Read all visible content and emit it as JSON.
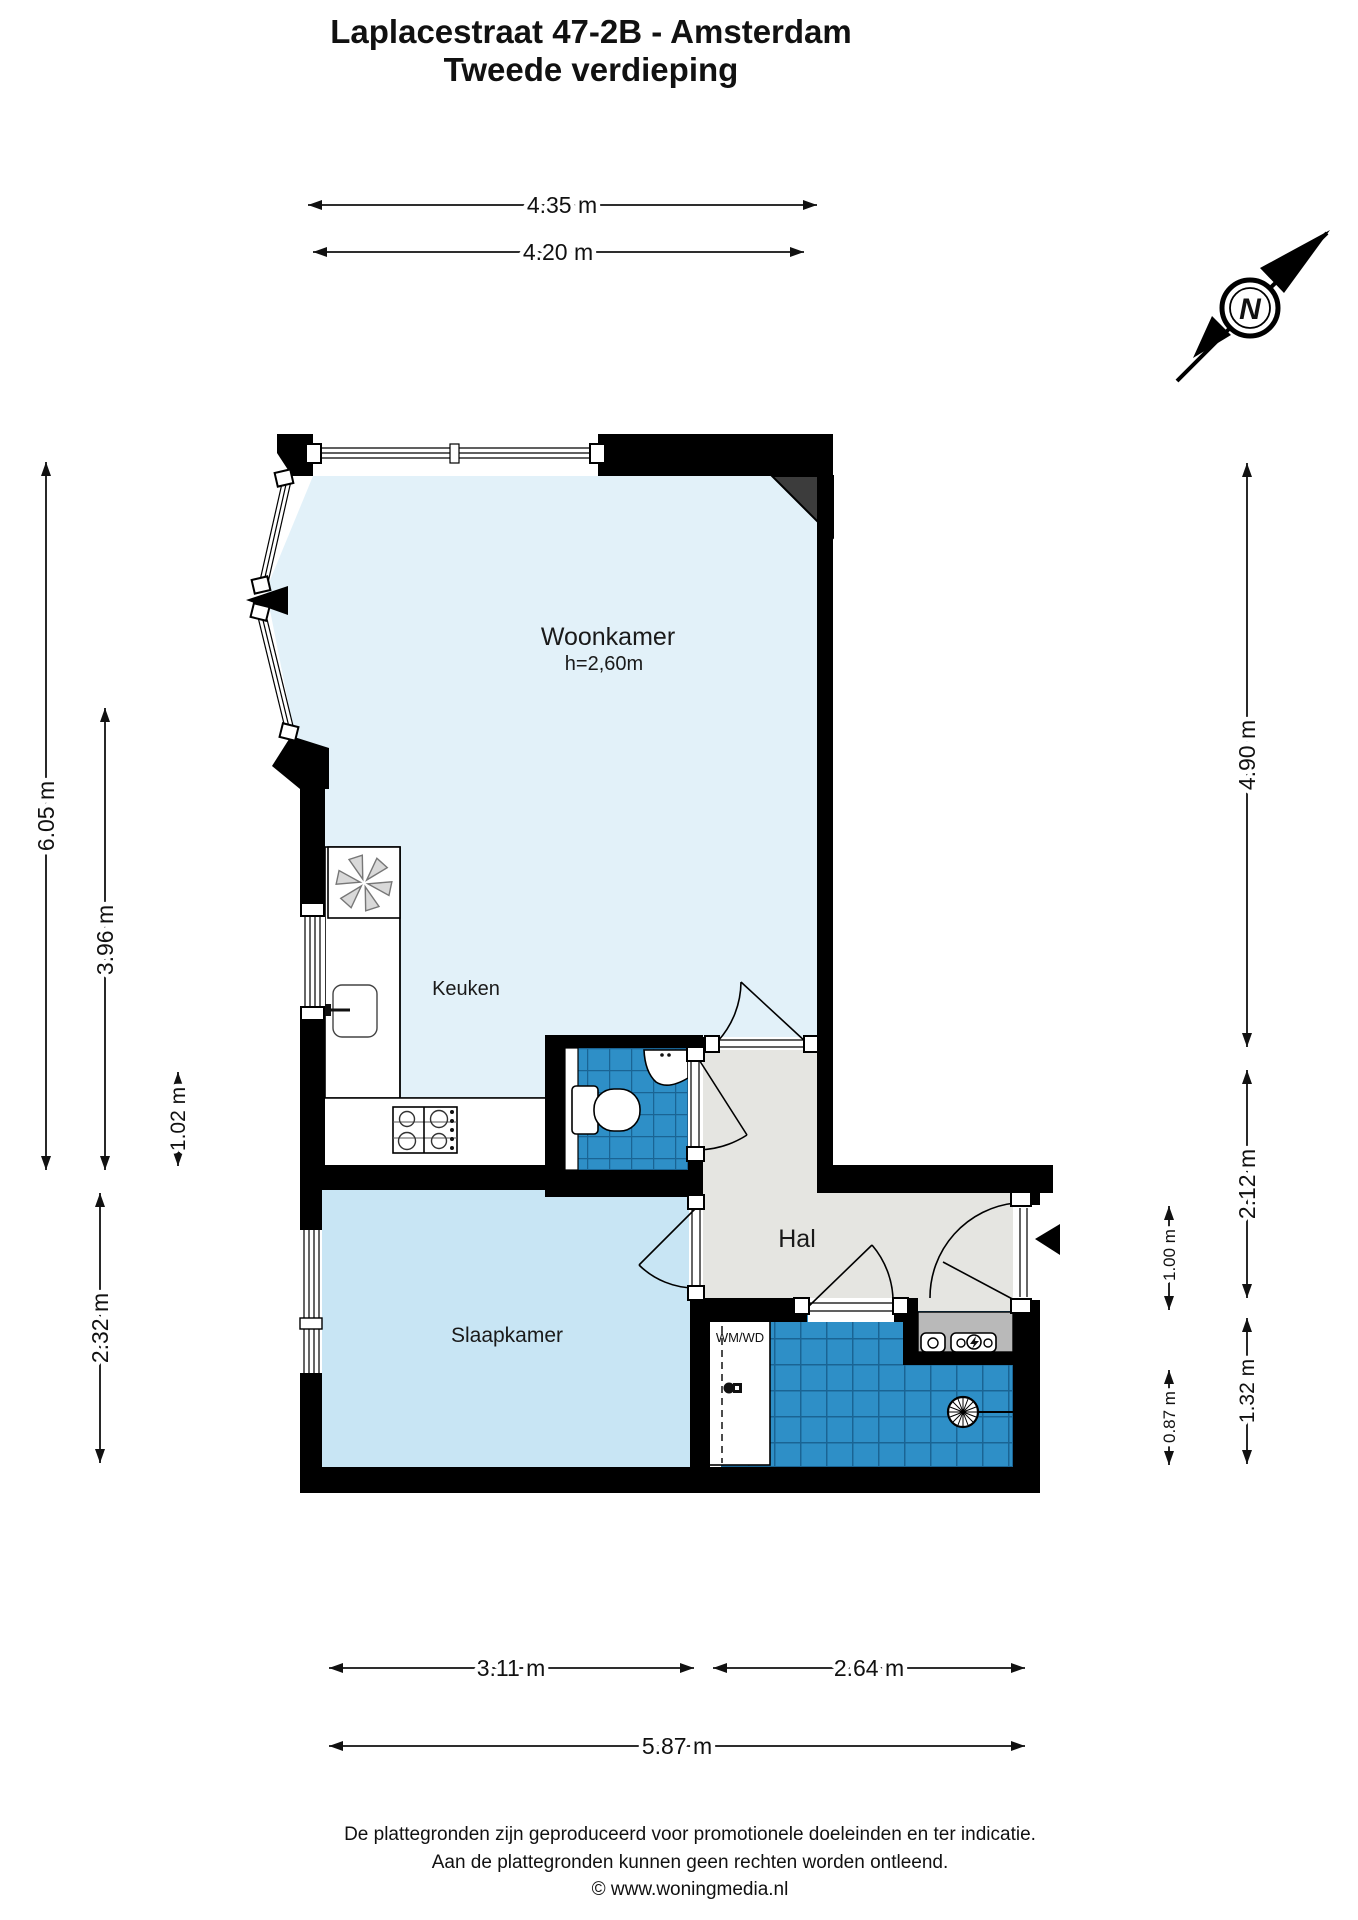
{
  "title": {
    "line1": "Laplacestraat 47-2B - Amsterdam",
    "line2": "Tweede verdieping"
  },
  "compass": {
    "north_label": "N"
  },
  "rooms": {
    "woonkamer": {
      "label": "Woonkamer",
      "ceiling_height": "h=2,60m"
    },
    "keuken": {
      "label": "Keuken"
    },
    "hal": {
      "label": "Hal"
    },
    "slaapkamer": {
      "label": "Slaapkamer"
    },
    "badkamer": {
      "washer_label": "WM/WD"
    }
  },
  "dimensions": {
    "top_outer": "4.35 m",
    "top_inner": "4.20 m",
    "left_outer": "6.05 m",
    "left_kitchen": "3.96 m",
    "left_small": "1.02 m",
    "left_bedroom": "2.32 m",
    "right_livingroom": "4.90 m",
    "right_hal": "2.12 m",
    "right_entrance": "1.00 m",
    "right_bathroom": "1.32 m",
    "right_niche": "0.87 m",
    "bottom_bedroom": "3.11 m",
    "bottom_bathroom": "2.64 m",
    "bottom_total": "5.87 m"
  },
  "footer": {
    "line1": "De plattegronden zijn geproduceerd voor promotionele doeleinden en ter indicatie.",
    "line2": "Aan de plattegronden kunnen geen rechten worden ontleend.",
    "line3": "© www.woningmedia.nl"
  },
  "colors": {
    "wall": "#000000",
    "floor_living": "#E2F1F9",
    "floor_bedroom": "#C8E5F4",
    "floor_hall": "#E5E5E1",
    "tile_blue": "#2E8FC7",
    "tile_grout": "#1A6494",
    "counter_gray": "#B9B9B9"
  }
}
